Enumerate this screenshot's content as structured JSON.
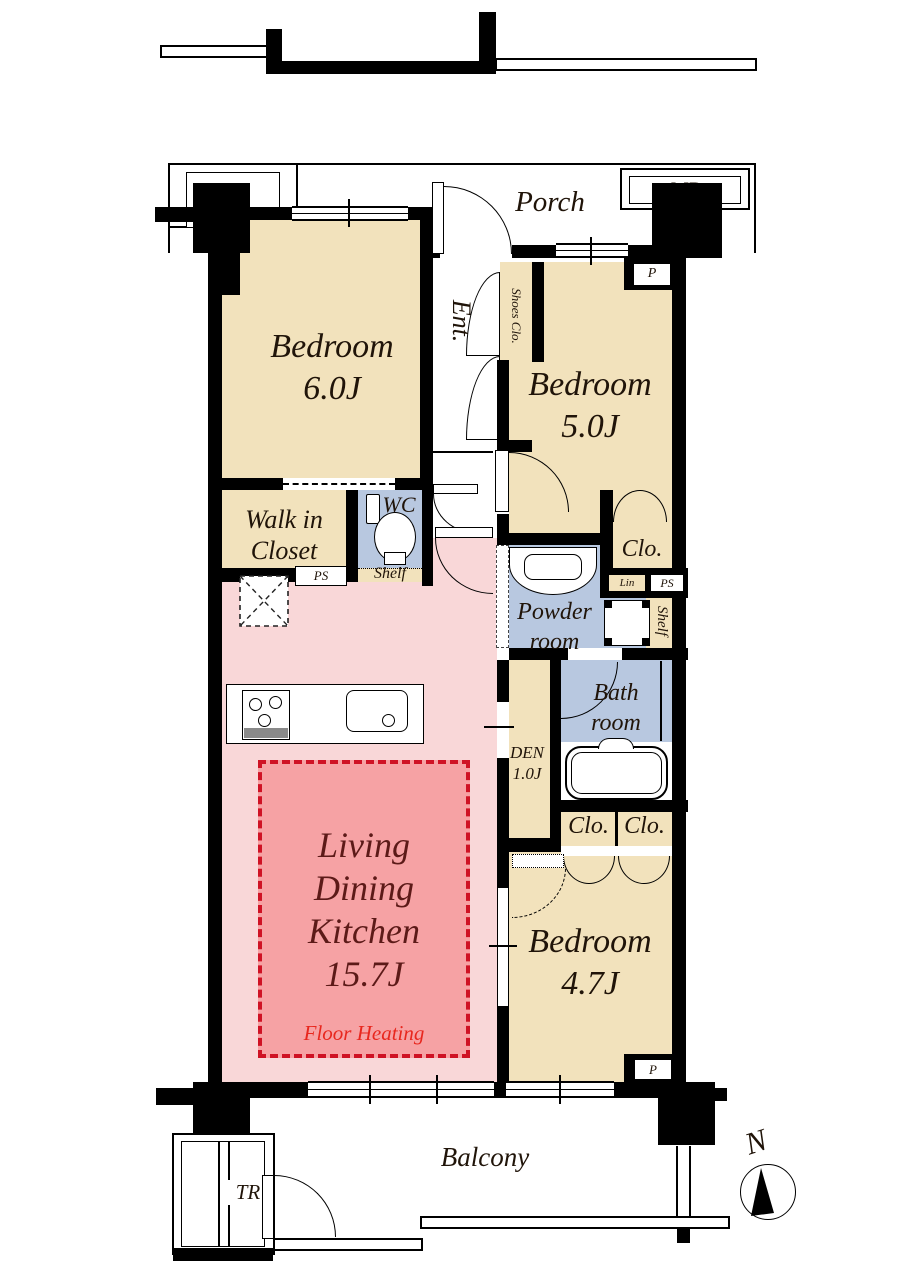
{
  "plan": {
    "porch_label": "Porch",
    "mb_label": "MB",
    "p_label_top": "P",
    "p_label_bottom": "P",
    "entrance_label": "Ent.",
    "shoes_closet_label": "Shoes Clo.",
    "bedroom_60": {
      "name": "Bedroom",
      "size": "6.0J"
    },
    "bedroom_50": {
      "name": "Bedroom",
      "size": "5.0J"
    },
    "bedroom_47": {
      "name": "Bedroom",
      "size": "4.7J"
    },
    "walk_in_closet": {
      "line1": "Walk in",
      "line2": "Closet"
    },
    "wc_label": "WC",
    "wc_shelf_label": "Shelf",
    "ps_label_left": "PS",
    "powder_room": {
      "line1": "Powder",
      "line2": "room"
    },
    "closet_bedroom50_label": "Clo.",
    "linen_label": "Lin",
    "ps_label_right": "PS",
    "shelf_right_label": "Shelf",
    "bath_room": {
      "line1": "Bath",
      "line2": "room"
    },
    "den": {
      "name": "DEN",
      "size": "1.0J"
    },
    "closet_left_label": "Clo.",
    "closet_right_label": "Clo.",
    "ldk": {
      "line1": "Living",
      "line2": "Dining",
      "line3": "Kitchen",
      "size": "15.7J",
      "note": "Floor Heating"
    },
    "balcony_label": "Balcony",
    "trunk_room_label": "TR",
    "north_label": "N"
  },
  "colors": {
    "wall": "#000000",
    "room_beige": "#f2e2bc",
    "wet_area_blue": "#b8c8e0",
    "ldk_pink": "#f9d7d8",
    "floor_heating_pink": "#f6a2a4",
    "floor_heating_border": "#cf1224",
    "ldk_text": "#5c1a18",
    "floor_heating_text": "#e8271e",
    "label_text": "#201409"
  }
}
